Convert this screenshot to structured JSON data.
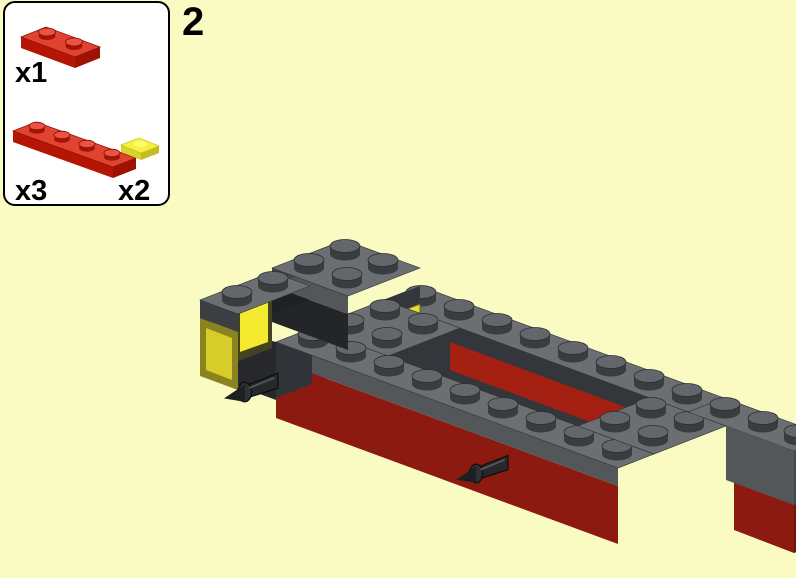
{
  "page": {
    "type": "LEGO building instruction step",
    "background_color": "#FAFAC3"
  },
  "step": {
    "number": "2"
  },
  "parts_callout": {
    "items": [
      {
        "part": "plate-1x2",
        "color_name": "red",
        "color": "#C91A09",
        "count_label": "x1"
      },
      {
        "part": "plate-1x4",
        "color_name": "red",
        "color": "#C91A09",
        "count_label": "x3"
      },
      {
        "part": "plate-1x1",
        "color_name": "trans-yellow",
        "color": "#F2EA30",
        "count_label": "x2"
      }
    ]
  },
  "model": {
    "description": "Isometric render of a vehicle chassis: dark red brick base, dark gray plates on top with open center, transparent yellow headlight bricks at front-left, two dark towball pins pointing front-left",
    "colors": {
      "dark_gray_top": "#6C6F71",
      "dark_gray_side": "#54575A",
      "dark_red_face": "#8C1A10",
      "dark_red_inner": "#A32013",
      "trans_yellow": "#F4EB31",
      "pin_dark": "#26282B",
      "hole_shadow": "#17181A"
    }
  }
}
